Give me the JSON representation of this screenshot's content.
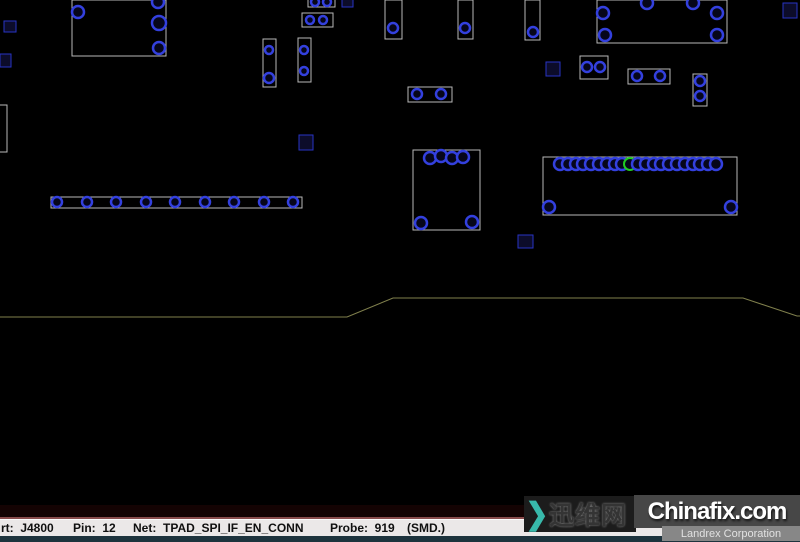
{
  "status_bar": {
    "part": "rt:  J4800",
    "pin": "Pin:  12",
    "net": "Net:  TPAD_SPI_IF_EN_CONN",
    "probe": "Probe:  919",
    "mount": "(SMD.)"
  },
  "watermark": {
    "cn_text": "迅维网",
    "site": "Chinafix.com",
    "subtitle": "Landrex Corporation",
    "accent_color": "#38b9ab"
  },
  "board": {
    "colors": {
      "edge": "#80804d",
      "silkscreen": "#b9b9b9",
      "component": "#2733c4",
      "component_fill": "#0c0c2a",
      "pad": "#3340de",
      "pad_fill": "#06061a",
      "selected": "#22cc22"
    },
    "edge_points": "0,317 347,317 393,298 743,298 797,316 800,316",
    "rects": [
      [
        72,
        0,
        94,
        56,
        "w"
      ],
      [
        385,
        0,
        17,
        39,
        "w"
      ],
      [
        458,
        0,
        15,
        39,
        "w"
      ],
      [
        525,
        0,
        15,
        40,
        "w"
      ],
      [
        597,
        0,
        130,
        43,
        "w"
      ],
      [
        302,
        13,
        31,
        14,
        "w"
      ],
      [
        308,
        -4,
        27,
        11,
        "w"
      ],
      [
        263,
        39,
        13,
        48,
        "w"
      ],
      [
        298,
        38,
        13,
        44,
        "w"
      ],
      [
        408,
        87,
        44,
        15,
        "w"
      ],
      [
        580,
        56,
        28,
        23,
        "w"
      ],
      [
        628,
        69,
        42,
        15,
        "w"
      ],
      [
        693,
        74,
        14,
        32,
        "w"
      ],
      [
        -4,
        105,
        11,
        47,
        "w"
      ],
      [
        413,
        150,
        67,
        80,
        "w"
      ],
      [
        543,
        157,
        194,
        58,
        "w"
      ],
      [
        51,
        197,
        251,
        11,
        "w"
      ],
      [
        4,
        21,
        12,
        11,
        "b"
      ],
      [
        0,
        54,
        11,
        13,
        "b"
      ],
      [
        342,
        -4,
        11,
        11,
        "b"
      ],
      [
        299,
        135,
        14,
        15,
        "b"
      ],
      [
        546,
        62,
        14,
        14,
        "b"
      ],
      [
        518,
        235,
        15,
        13,
        "b"
      ],
      [
        783,
        3,
        14,
        15,
        "b"
      ]
    ],
    "pads": [
      [
        78,
        12,
        6
      ],
      [
        158,
        2,
        6
      ],
      [
        159,
        23,
        7
      ],
      [
        159,
        48,
        6
      ],
      [
        393,
        28,
        5
      ],
      [
        465,
        28,
        5
      ],
      [
        533,
        32,
        5
      ],
      [
        603,
        13,
        6
      ],
      [
        647,
        3,
        6
      ],
      [
        693,
        3,
        6
      ],
      [
        717,
        13,
        6
      ],
      [
        605,
        35,
        6
      ],
      [
        717,
        35,
        6
      ],
      [
        269,
        50,
        4
      ],
      [
        269,
        78,
        5
      ],
      [
        304,
        50,
        4
      ],
      [
        304,
        71,
        4
      ],
      [
        417,
        94,
        5
      ],
      [
        441,
        94,
        5
      ],
      [
        587,
        67,
        5
      ],
      [
        600,
        67,
        5
      ],
      [
        637,
        76,
        5
      ],
      [
        660,
        76,
        5
      ],
      [
        700,
        81,
        5
      ],
      [
        700,
        96,
        5
      ],
      [
        310,
        20,
        4
      ],
      [
        323,
        20,
        4
      ],
      [
        315,
        2,
        4
      ],
      [
        327,
        2,
        4
      ],
      [
        430,
        158,
        6
      ],
      [
        441,
        156,
        6
      ],
      [
        452,
        158,
        6
      ],
      [
        463,
        157,
        6
      ],
      [
        421,
        223,
        6
      ],
      [
        472,
        222,
        6
      ],
      [
        57,
        202,
        5
      ],
      [
        87,
        202,
        5
      ],
      [
        116,
        202,
        5
      ],
      [
        146,
        202,
        5
      ],
      [
        175,
        202,
        5
      ],
      [
        205,
        202,
        5
      ],
      [
        234,
        202,
        5
      ],
      [
        264,
        202,
        5
      ],
      [
        293,
        202,
        5
      ],
      [
        560,
        164,
        6
      ],
      [
        568,
        164,
        6
      ],
      [
        576,
        164,
        6
      ],
      [
        583,
        164,
        6
      ],
      [
        591,
        164,
        6
      ],
      [
        599,
        164,
        6
      ],
      [
        607,
        164,
        6
      ],
      [
        615,
        164,
        6
      ],
      [
        622,
        164,
        6
      ],
      [
        630,
        164,
        6,
        1
      ],
      [
        638,
        164,
        6
      ],
      [
        646,
        164,
        6
      ],
      [
        654,
        164,
        6
      ],
      [
        661,
        164,
        6
      ],
      [
        669,
        164,
        6
      ],
      [
        677,
        164,
        6
      ],
      [
        685,
        164,
        6
      ],
      [
        693,
        164,
        6
      ],
      [
        700,
        164,
        6
      ],
      [
        708,
        164,
        6
      ],
      [
        716,
        164,
        6
      ],
      [
        549,
        207,
        6
      ],
      [
        731,
        207,
        6
      ]
    ]
  }
}
